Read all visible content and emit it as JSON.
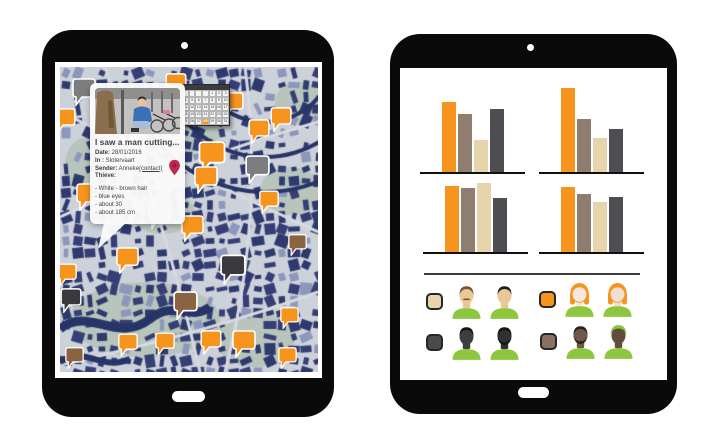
{
  "left_tablet": {
    "popup": {
      "title": "I saw a man cutting...",
      "fields": [
        {
          "label": "Date:",
          "value": "28/01/2016"
        },
        {
          "label": "In :",
          "value": "Slotervaart"
        },
        {
          "label": "Sender:",
          "value": "Anneke",
          "link": "(contact)"
        },
        {
          "label": "Thieve:",
          "value": ""
        }
      ],
      "description_lines": [
        "- White - brown hair",
        "- blue eyes",
        "- about 30",
        "- about 185 cm"
      ]
    },
    "calendar": {
      "rows": 5,
      "cols": 7,
      "start_offset": 4,
      "days_in_month": 31,
      "highlight_day": 28,
      "highlight_color": "#f7941d"
    },
    "map": {
      "palette": {
        "ground": "#cdd2da",
        "block_navy": "#2e3a6e",
        "block_light": "#8d97bb",
        "road": "#d7dae0",
        "park": "#b9c5bc",
        "water": "#273467"
      },
      "marker_color": "#c2274f",
      "pin_colors": {
        "orange": "#f7941d",
        "gray": "#7d7d7f",
        "dark": "#3a3a3c",
        "brown": "#8a6340",
        "light": "#e9e4d8"
      },
      "pins": [
        {
          "x": 12,
          "y": 11,
          "c": "gray",
          "s": 1.0
        },
        {
          "x": 105,
          "y": 6,
          "c": "orange",
          "s": 0.9
        },
        {
          "x": 162,
          "y": 25,
          "c": "orange",
          "s": 0.9
        },
        {
          "x": -6,
          "y": 41,
          "c": "orange",
          "s": 0.9
        },
        {
          "x": 210,
          "y": 40,
          "c": "orange",
          "s": 0.9
        },
        {
          "x": 188,
          "y": 52,
          "c": "orange",
          "s": 0.9
        },
        {
          "x": 138,
          "y": 74,
          "c": "orange",
          "s": 1.15
        },
        {
          "x": 185,
          "y": 88,
          "c": "gray",
          "s": 1.05
        },
        {
          "x": 134,
          "y": 99,
          "c": "orange",
          "s": 1.0
        },
        {
          "x": 88,
          "y": 134,
          "c": "light",
          "s": 1.0
        },
        {
          "x": 199,
          "y": 123,
          "c": "orange",
          "s": 0.85
        },
        {
          "x": 16,
          "y": 116,
          "c": "orange",
          "s": 1.0
        },
        {
          "x": 121,
          "y": 148,
          "c": "orange",
          "s": 0.95
        },
        {
          "x": 228,
          "y": 167,
          "c": "brown",
          "s": 0.8
        },
        {
          "x": 160,
          "y": 187,
          "c": "dark",
          "s": 1.1
        },
        {
          "x": 56,
          "y": 180,
          "c": "orange",
          "s": 0.95
        },
        {
          "x": -3,
          "y": 196,
          "c": "orange",
          "s": 0.85
        },
        {
          "x": 0,
          "y": 221,
          "c": "dark",
          "s": 0.9
        },
        {
          "x": 113,
          "y": 224,
          "c": "brown",
          "s": 1.05
        },
        {
          "x": 220,
          "y": 240,
          "c": "orange",
          "s": 0.8
        },
        {
          "x": 58,
          "y": 266,
          "c": "orange",
          "s": 0.85
        },
        {
          "x": 95,
          "y": 265,
          "c": "orange",
          "s": 0.85
        },
        {
          "x": 140,
          "y": 263,
          "c": "orange",
          "s": 0.9
        },
        {
          "x": 172,
          "y": 263,
          "c": "orange",
          "s": 1.0
        },
        {
          "x": 5,
          "y": 280,
          "c": "brown",
          "s": 0.8
        },
        {
          "x": 218,
          "y": 280,
          "c": "orange",
          "s": 0.8
        }
      ]
    }
  },
  "right_tablet": {
    "legend_groups": [
      {
        "swatch": "#e7d5ab",
        "avatars": [
          {
            "type": "male",
            "skin": "#eac795",
            "hair": "#7a5230",
            "shirt": "#8dc63f",
            "mustache": true
          },
          {
            "type": "male",
            "skin": "#eac795",
            "hair": "#1c1c1c",
            "shirt": "#8dc63f"
          }
        ]
      },
      {
        "swatch": "#f7941d",
        "avatars": [
          {
            "type": "female",
            "skin": "#f5e8dc",
            "hair": "#f7941d",
            "shirt": "#8dc63f"
          },
          {
            "type": "female",
            "skin": "#f0dfd2",
            "hair": "#f7941d",
            "shirt": "#8dc63f"
          }
        ]
      },
      {
        "swatch": "#4a4a4c",
        "avatars": [
          {
            "type": "male",
            "skin": "#3e3e40",
            "hair": "#141414",
            "shirt": "#8dc63f"
          },
          {
            "type": "male",
            "skin": "#303032",
            "hair": "#141414",
            "shirt": "#8dc63f",
            "beard": true
          }
        ]
      },
      {
        "swatch": "#8a7162",
        "avatars": [
          {
            "type": "male",
            "skin": "#6f5847",
            "hair": "#2a2118",
            "shirt": "#8dc63f",
            "beard": true
          },
          {
            "type": "hood",
            "skin": "#5f4c3b",
            "hair": "#8dc63f",
            "shirt": "#8dc63f"
          }
        ]
      }
    ]
  },
  "chart_data": [
    {
      "type": "bar",
      "position": "top-left",
      "title": "",
      "xlabel": "",
      "ylabel": "",
      "categories": [
        "orange",
        "taupe",
        "cream",
        "dark-gray"
      ],
      "series_colors": [
        "#f7941d",
        "#8f7d70",
        "#e6d5ac",
        "#4e4e52"
      ],
      "values": [
        70,
        58,
        32,
        63
      ],
      "ylim": [
        0,
        90
      ],
      "grid": false,
      "legend": "avatar groups below"
    },
    {
      "type": "bar",
      "position": "top-right",
      "title": "",
      "xlabel": "",
      "ylabel": "",
      "categories": [
        "orange",
        "taupe",
        "cream",
        "dark-gray"
      ],
      "series_colors": [
        "#f7941d",
        "#8f7d70",
        "#e6d5ac",
        "#4e4e52"
      ],
      "values": [
        84,
        53,
        34,
        43
      ],
      "ylim": [
        0,
        90
      ],
      "grid": false
    },
    {
      "type": "bar",
      "position": "bottom-left",
      "title": "",
      "xlabel": "",
      "ylabel": "",
      "categories": [
        "orange",
        "taupe",
        "cream",
        "dark-gray"
      ],
      "series_colors": [
        "#f7941d",
        "#8f7d70",
        "#e6d5ac",
        "#4e4e52"
      ],
      "values": [
        66,
        64,
        69,
        54
      ],
      "ylim": [
        0,
        75
      ],
      "grid": false
    },
    {
      "type": "bar",
      "position": "bottom-right",
      "title": "",
      "xlabel": "",
      "ylabel": "",
      "categories": [
        "orange",
        "taupe",
        "cream",
        "dark-gray"
      ],
      "series_colors": [
        "#f7941d",
        "#8f7d70",
        "#e6d5ac",
        "#4e4e52"
      ],
      "values": [
        65,
        58,
        50,
        55
      ],
      "ylim": [
        0,
        75
      ],
      "grid": false
    }
  ]
}
